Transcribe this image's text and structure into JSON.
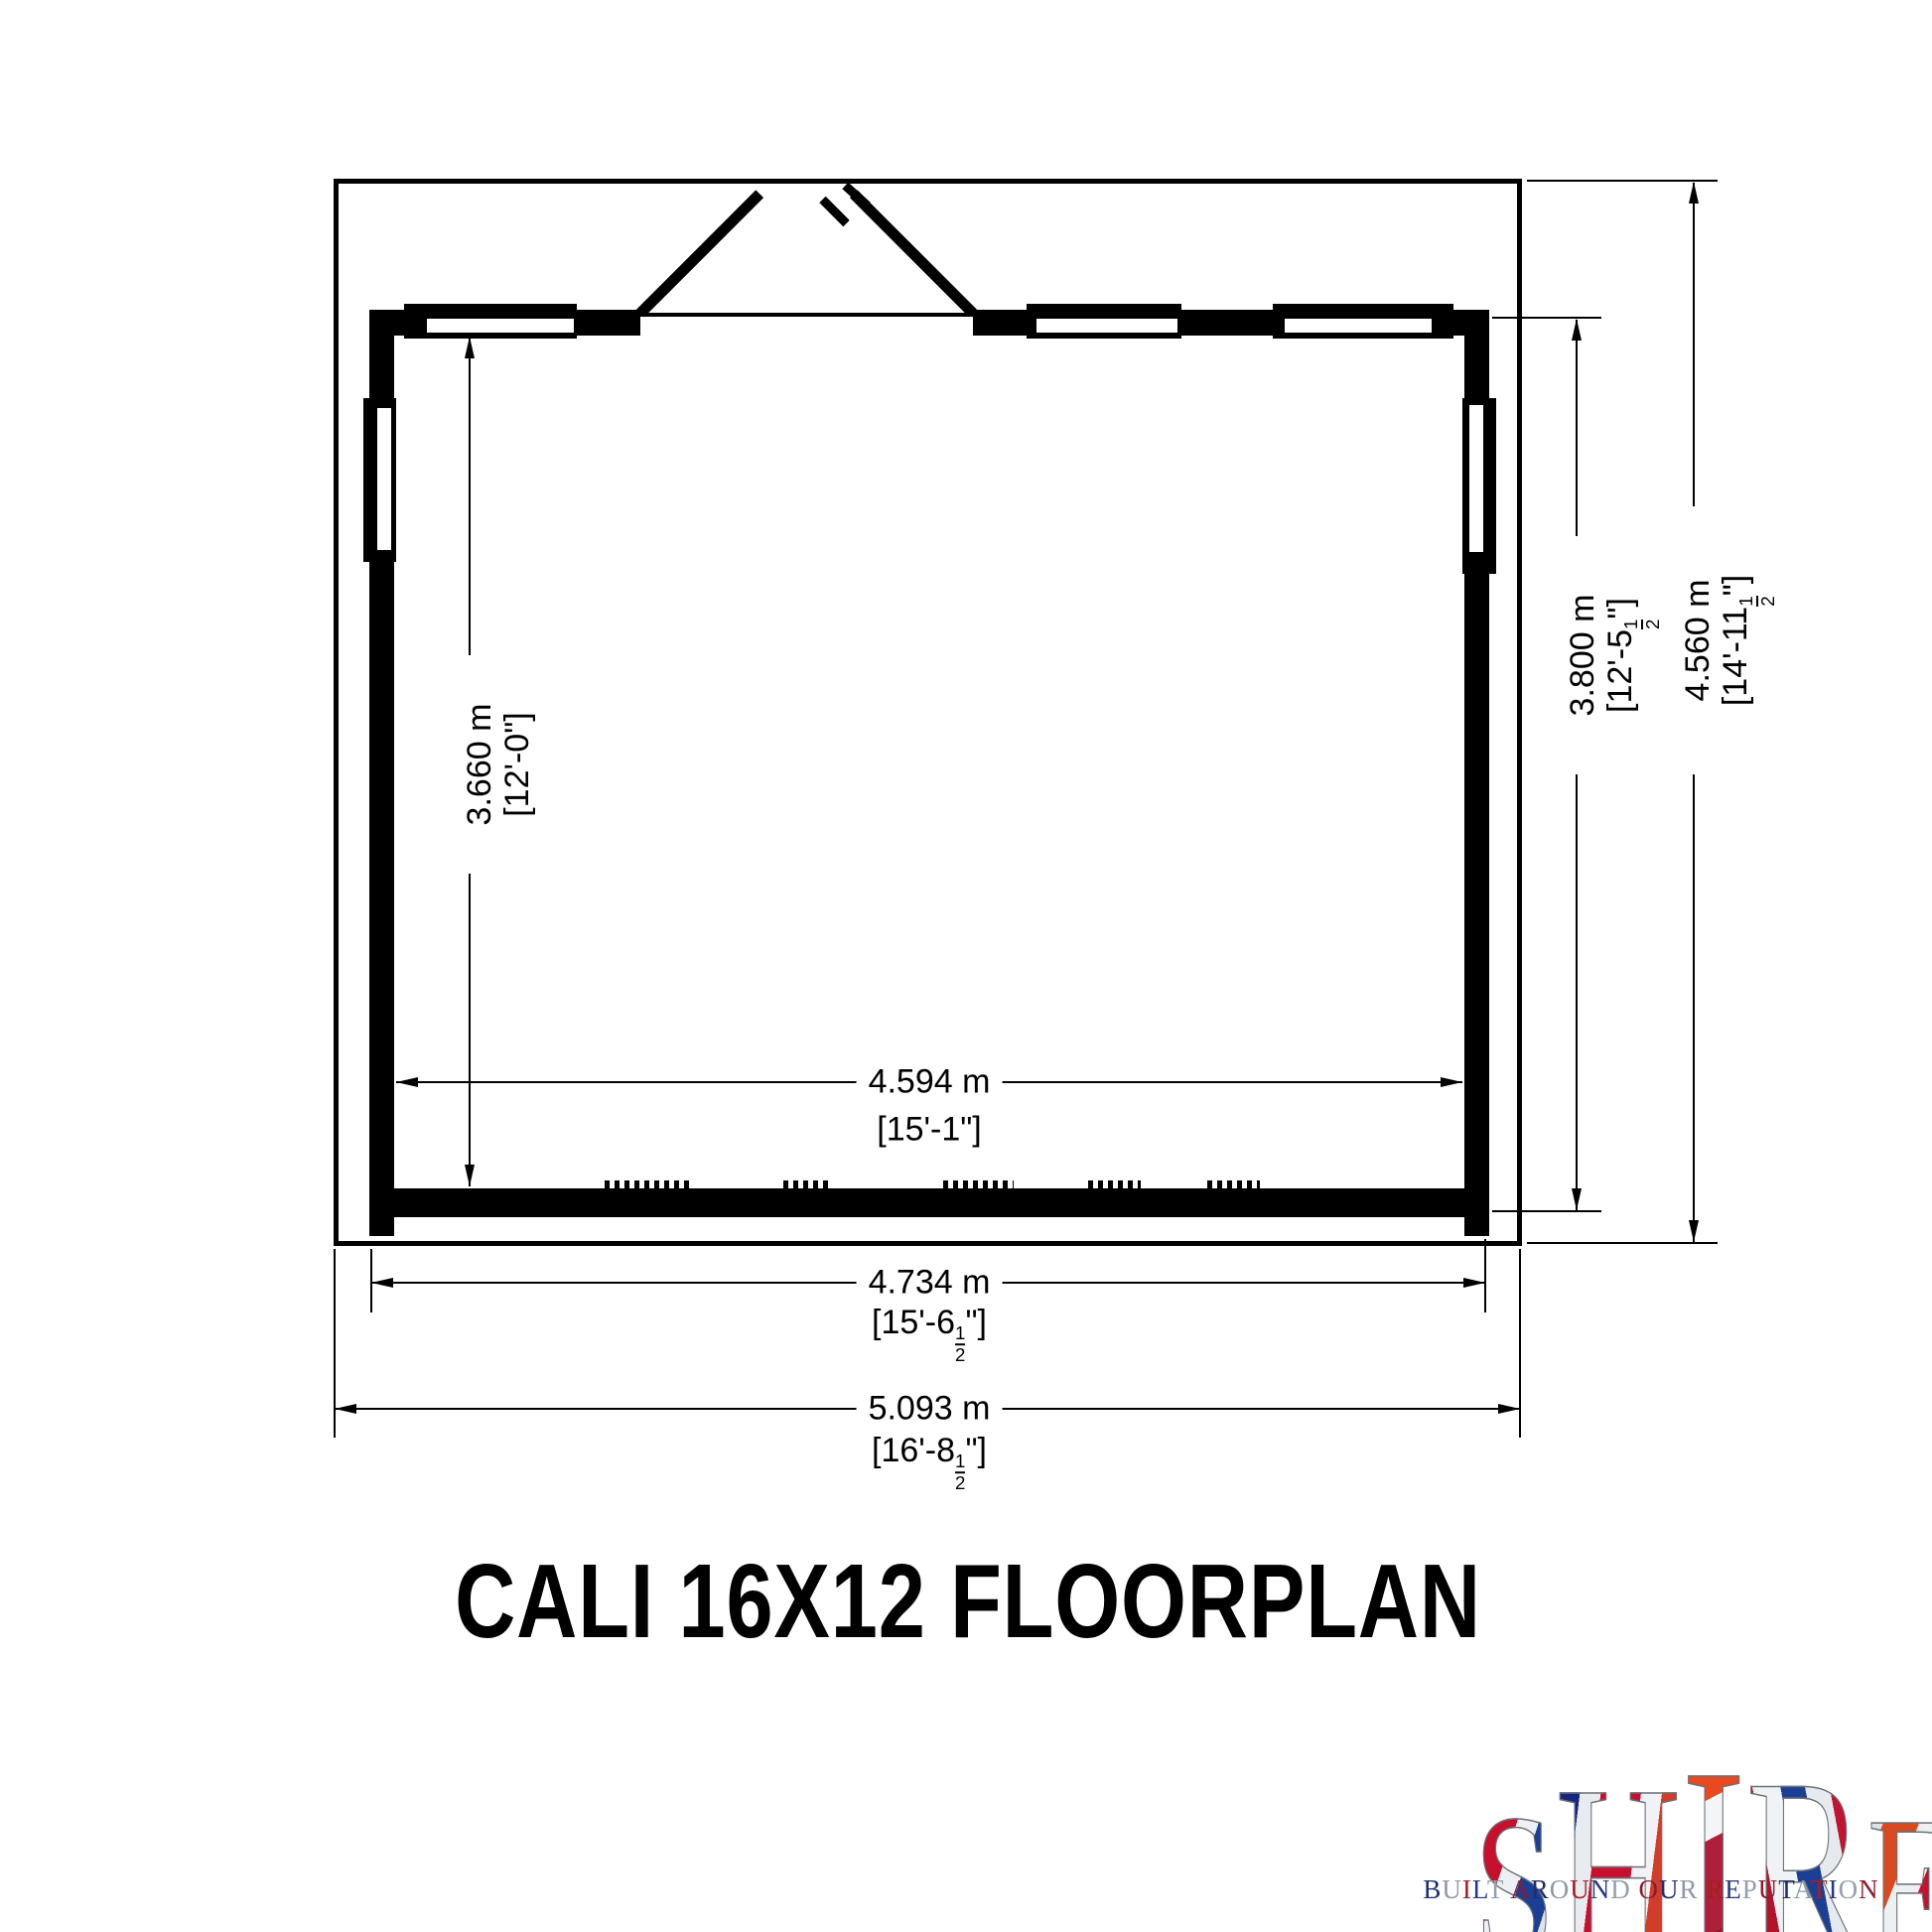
{
  "title": "CALI 16X12 FLOORPLAN",
  "dimensions": {
    "interior_width": {
      "metric": "4.594 m",
      "imperial": "[15'-1\"]"
    },
    "interior_depth": {
      "metric": "3.660 m",
      "imperial": "[12'-0\"]"
    },
    "building_width": {
      "metric": "4.734 m",
      "imperial_prefix": "[15'-6",
      "fraction_numerator": "1",
      "fraction_denominator": "2",
      "imperial_suffix": "\"]"
    },
    "building_depth": {
      "metric": "3.800 m",
      "imperial_prefix": "[12'-5",
      "fraction_numerator": "1",
      "fraction_denominator": "2",
      "imperial_suffix": "\"]"
    },
    "overall_width": {
      "metric": "5.093 m",
      "imperial_prefix": "[16'-8",
      "fraction_numerator": "1",
      "fraction_denominator": "2",
      "imperial_suffix": "\"]"
    },
    "overall_depth": {
      "metric": "4.560 m",
      "imperial_prefix": "[14'-11",
      "fraction_numerator": "1",
      "fraction_denominator": "2",
      "imperial_suffix": "\"]"
    }
  },
  "logo": {
    "letters": [
      "S",
      "H",
      "I",
      "R",
      "E"
    ],
    "tagline": "BUILT AROUND OUR REPUTATION",
    "tagline_palette": [
      "#1d2e6e",
      "#8d99a8",
      "#a81e24",
      "#273a7d",
      "#93a0ae",
      "#8c1b2f"
    ],
    "flag_red": "#c8102e",
    "flag_blue": "#1b3f94",
    "flag_white": "#eef1f4"
  },
  "drawing": {
    "ink": "#000000",
    "paper": "#ffffff"
  }
}
